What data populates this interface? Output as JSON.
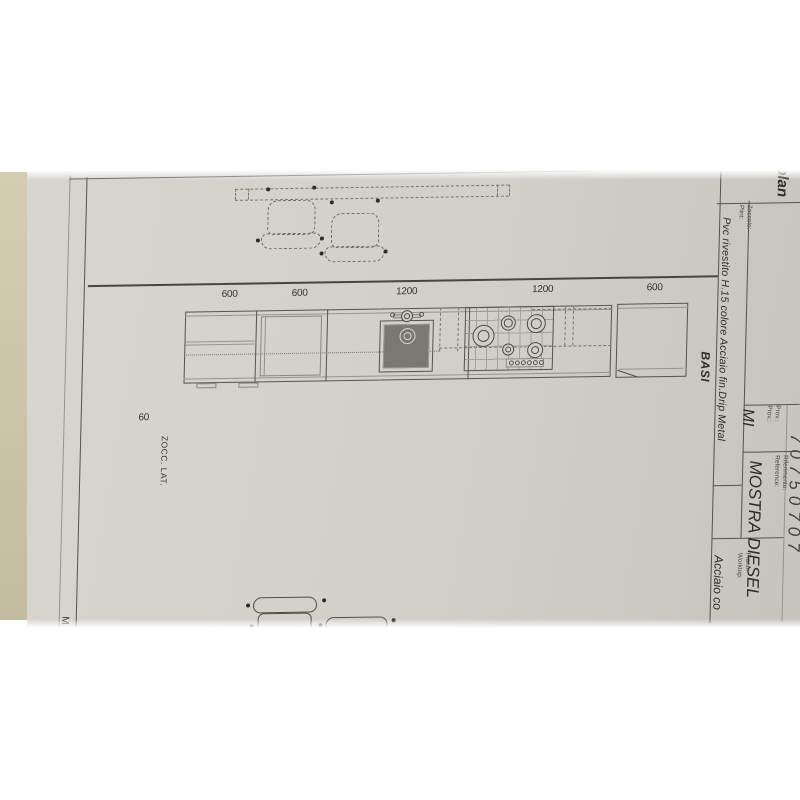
{
  "title_block": {
    "view_label": "plan",
    "zoccolo_label_it": "Zoccolo:",
    "zoccolo_label_en": "Plint:",
    "zoccolo_value": "Pvc rivestito H.15 colore Acciaio fin.Drip Metal",
    "basi_label": "BASI",
    "prov_label_it": "Prov.:",
    "prov_label_en": "Prov.:",
    "prov_value": "MI",
    "riferimento_label_it": "Riferimento:",
    "riferimento_label_en": "Reference:",
    "riferimento_value": "MOSTRA DIESEL",
    "piano_label_it": "Piano:",
    "piano_label_en": "Worktop:",
    "piano_value": "Acciaio co",
    "edge_number": "70750707"
  },
  "drawing": {
    "dimensions": [
      "600",
      "600",
      "1200",
      "1200",
      "600"
    ],
    "plinth_side_dim": "60",
    "plinth_side_label": "ZOCC. LAT.",
    "margin_letter": "M"
  },
  "colors": {
    "paper": "#d2cfc9",
    "backdrop_strip": "#cbc3a6",
    "linework": "#55534f"
  }
}
